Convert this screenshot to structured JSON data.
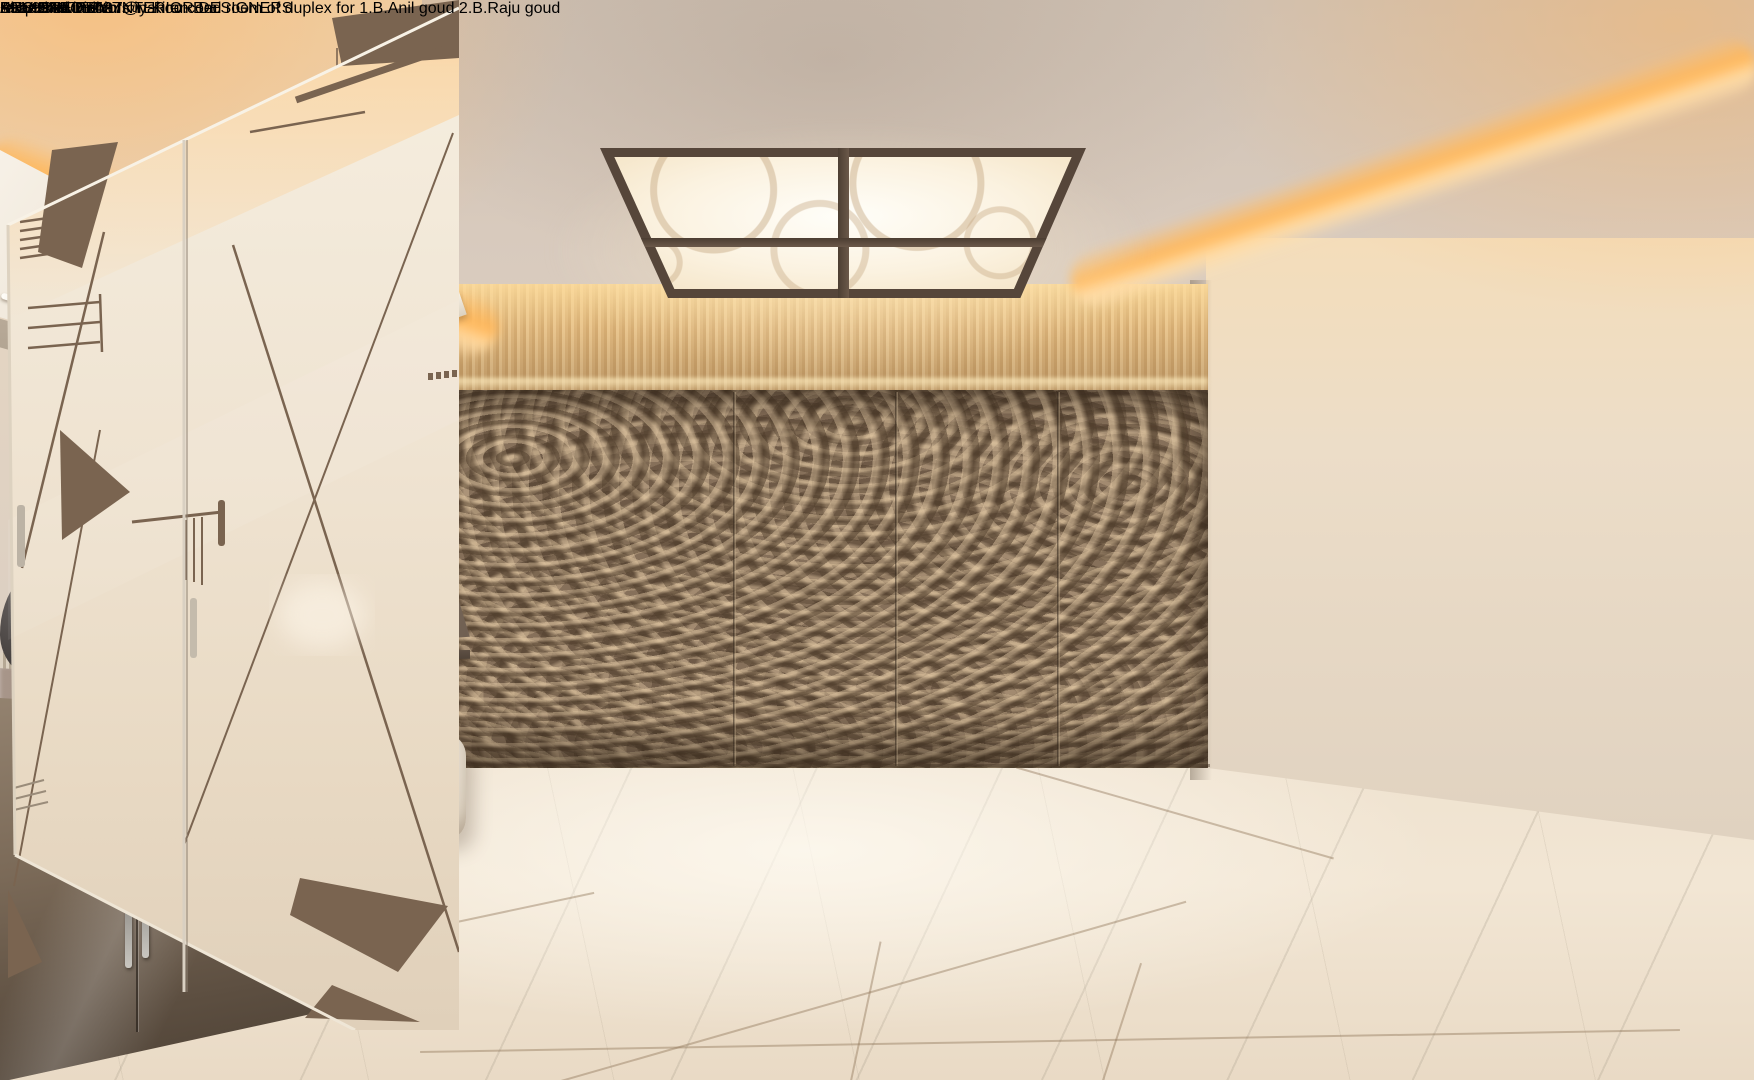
{
  "overlay": {
    "title": "Kiran Bed Room",
    "subtitle": "Proposed interiors in Kiran Bed room of duplex for 1.B.Anil goud  2.B.Raju goud",
    "credits": {
      "designed_by": "DESIGNED BY",
      "firm": "SUVIDHA 7",
      "tagline": "ARCHITECETS  INTERIOR DESIGNERS",
      "phone": "+91 9949757427",
      "email": "ramesh-suvidha7@yahoo.com"
    }
  },
  "palette": {
    "cove_glow": "#f6a94a",
    "ceiling": "#d6c9bd",
    "wall": "#e2d5c6",
    "wood_band": "#d9b382",
    "carved_panel": "#86705b",
    "floor": "#efe3d1",
    "rug": "#4b3f31",
    "furniture_taupe": "#8a796b",
    "bedding": "#d9cebd",
    "wardrobe": "#efe4d3",
    "decal_brown": "#7a6450",
    "text_gray": "#85827e"
  }
}
